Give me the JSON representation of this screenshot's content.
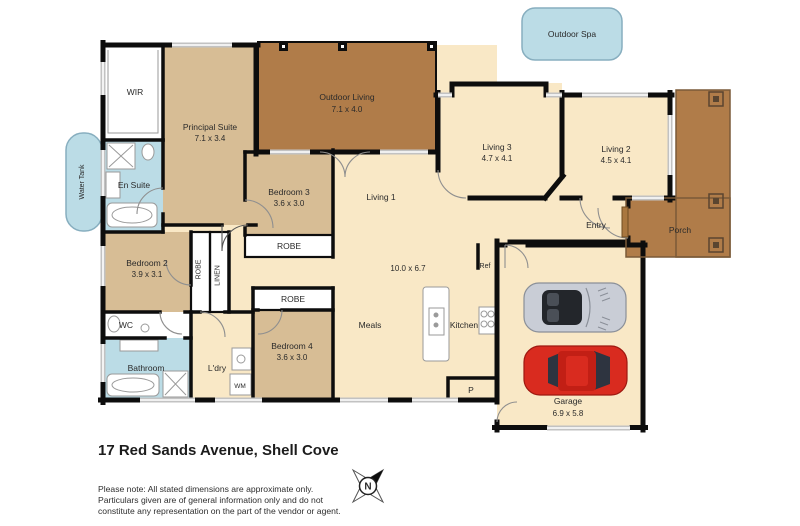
{
  "title": "17 Red Sands Avenue, Shell Cove",
  "disclaimer": [
    "Please note: All stated dimensions are approximate only.",
    "Particulars given are of general information only and do not",
    "constitute any representation on the part of the vendor or agent."
  ],
  "compass": {
    "north_label": "N"
  },
  "outdoor": {
    "spa": {
      "label": "Outdoor Spa"
    },
    "water_tank": {
      "label": "Water Tank"
    },
    "outdoor_living": {
      "label": "Outdoor Living",
      "dims": "7.1 x 4.0"
    },
    "porch": {
      "label": "Porch"
    }
  },
  "rooms": {
    "wir": {
      "label": "WIR"
    },
    "principal": {
      "label": "Principal Suite",
      "dims": "7.1 x 3.4"
    },
    "ensuite": {
      "label": "En Suite"
    },
    "bedroom2": {
      "label": "Bedroom 2",
      "dims": "3.9 x 3.1"
    },
    "bedroom3": {
      "label": "Bedroom 3",
      "dims": "3.6 x 3.0"
    },
    "bedroom4": {
      "label": "Bedroom 4",
      "dims": "3.6 x 3.0"
    },
    "living1": {
      "label": "Living 1",
      "dims": "10.0 x 6.7"
    },
    "living2": {
      "label": "Living 2",
      "dims": "4.5 x 4.1"
    },
    "living3": {
      "label": "Living 3",
      "dims": "4.7 x 4.1"
    },
    "meals": {
      "label": "Meals"
    },
    "kitchen": {
      "label": "Kitchen"
    },
    "entry": {
      "label": "Entry"
    },
    "wc": {
      "label": "WC"
    },
    "bathroom": {
      "label": "Bathroom"
    },
    "laundry": {
      "label": "L'dry"
    },
    "garage": {
      "label": "Garage",
      "dims": "6.9 x 5.8"
    }
  },
  "closets": {
    "robe": "ROBE",
    "linen": "LINEN"
  },
  "fixtures": {
    "wm": "WM",
    "ref": "Ref",
    "pantry": "P"
  },
  "colors": {
    "floor_cream": "#F9E8C6",
    "floor_tan": "#D7BD95",
    "deck_brown": "#B07C49",
    "wet_blue": "#BBDCE6",
    "wall_black": "#0d0d0d",
    "car_red": "#D92B1F",
    "car_silver": "#C9CDD6"
  }
}
